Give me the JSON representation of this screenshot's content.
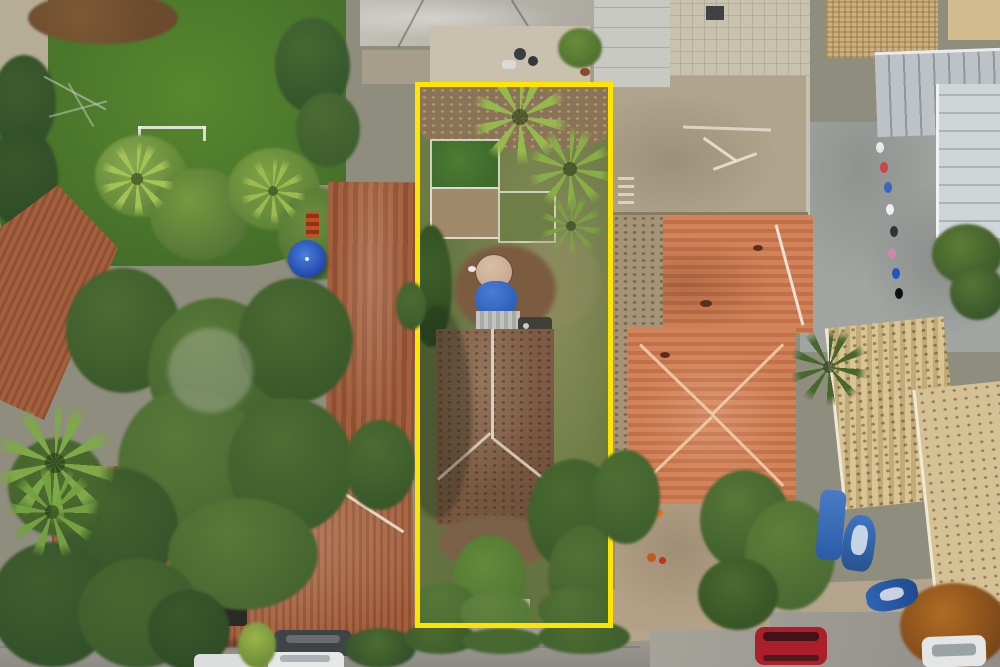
{
  "scene": {
    "type": "aerial-drone-photograph",
    "subject": "residential neighborhood with one narrow vacant-style lot outlined by a yellow property-boundary rectangle",
    "annotation": {
      "shape": "rectangle-outline",
      "color": "#ffe400",
      "stroke_px": 5
    },
    "visible_text": "",
    "objects": [
      "outlined-lot-with-old-tile-roof-house",
      "vegetable-garden-beds",
      "water-tank",
      "blue-tarp",
      "palm-trees",
      "green-lawn-with-soccer-goal",
      "banana-trees",
      "dense-tree-canopy",
      "weathered-terracotta-roofs",
      "bright-orange-hip-roof-house",
      "vacant-dirt-lot-with-debris",
      "gray-metal-roofs",
      "straw-tan-roofs",
      "courtyard-with-clothesline",
      "blue-umbrella",
      "blue-boat",
      "jet-ski",
      "red-van",
      "white-cars",
      "dark-car",
      "street-pavement",
      "rust-colored-tree"
    ]
  },
  "palette": {
    "accent-yellow": "#ffe400",
    "lawn-green": "#4f7c2e",
    "lot-grass": "#6a7a44",
    "canopy-dark": "#33512a",
    "canopy-mid": "#44642f",
    "leaf-light": "#6f9440",
    "palm-bright": "#95b94c",
    "roof-weathered": "#a4603c",
    "roof-weathered-dark": "#8e4f33",
    "roof-orange": "#d2835a",
    "roof-orange-dark": "#c27049",
    "roof-tan": "#d6c194",
    "roof-straw": "#c9b07e",
    "roof-old-house": "#7c5a43",
    "metal-gray": "#bcc2c5",
    "pave-gray": "#9c9a93",
    "dirt-tan": "#b1a48c",
    "dirt-brown": "#8b7356",
    "tarp-blue": "#2d5fb8",
    "umbrella-blue": "#2b57c4",
    "tank-tan": "#c7a68d",
    "car-red": "#ab1f2b",
    "car-white": "#e4e6e6",
    "car-dark": "#3f4347",
    "boat-blue": "#2e66b8",
    "rust-tree": "#9a5d20",
    "ridge-white": "#e9e2d2"
  }
}
